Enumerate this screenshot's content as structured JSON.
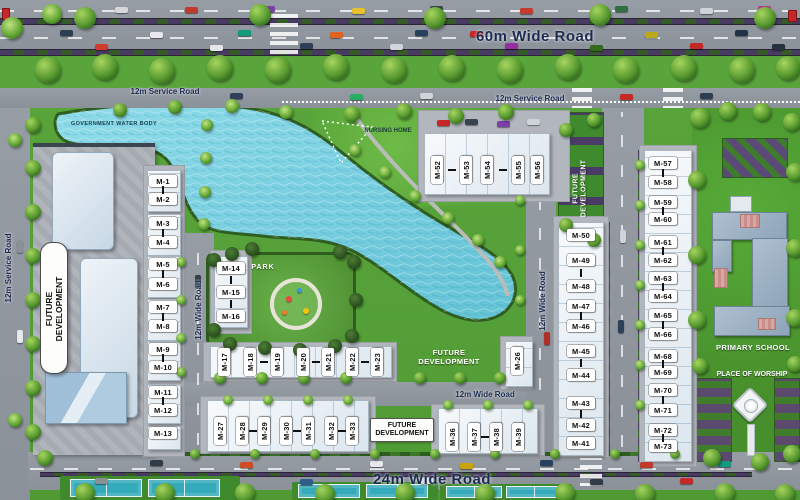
{
  "roads": {
    "highway": "60m Wide Road",
    "service_top_left": "12m Service Road",
    "service_top_right": "12m Service Road",
    "service_left": "12m Service Road",
    "wide_mid": "12m Wide Road",
    "wide_center": "12m Wide Road",
    "wide_horizontal": "12m Wide Road",
    "bottom": "24m Wide Road"
  },
  "landmarks": {
    "water_body": "GOVERNMENT WATER BODY",
    "nursing_home": "NURSING HOME",
    "park": "PARK",
    "primary_school": "PRIMARY SCHOOL",
    "place_of_worship": "PLACE OF WORSHIP"
  },
  "future_development": [
    "FUTURE DEVELOPMENT",
    "FUTURE DEVELOPMENT",
    "FUTURE DEVELOPMENT",
    "FUTURE DEVELOPMENT"
  ],
  "buildings": {
    "left_column": [
      "M-1",
      "M-2",
      "M-3",
      "M-4",
      "M-5",
      "M-6",
      "M-7",
      "M-8",
      "M-9",
      "M-10",
      "M-11",
      "M-12",
      "M-13"
    ],
    "mid_column": [
      "M-14",
      "M-15",
      "M-16"
    ],
    "row_upper": [
      "M-17",
      "M-18",
      "M-19",
      "M-20",
      "M-21",
      "M-22",
      "M-23"
    ],
    "row_lower": [
      "M-27",
      "M-28",
      "M-29",
      "M-30",
      "M-31",
      "M-32",
      "M-33"
    ],
    "row_south_center": [
      "M-36",
      "M-37",
      "M-38",
      "M-39"
    ],
    "standalone": [
      "M-26"
    ],
    "center_column": [
      "M-50",
      "M-49",
      "M-48",
      "M-47",
      "M-46",
      "M-45",
      "M-44",
      "M-43",
      "M-42",
      "M-41"
    ],
    "north_row": [
      "M-52",
      "M-53",
      "M-54",
      "M-55",
      "M-56"
    ],
    "east_column": [
      "M-57",
      "M-58",
      "M-59",
      "M-60",
      "M-61",
      "M-62",
      "M-63",
      "M-64",
      "M-65",
      "M-66",
      "M-68",
      "M-69",
      "M-70",
      "M-71",
      "M-72",
      "M-73"
    ]
  },
  "colors": {
    "water": "#7ed1e2",
    "water_deep": "#5fbcd2",
    "grass": "#55a038",
    "road": "#90969e",
    "road_label": "#1b2a50",
    "building": "#f2f6fa",
    "label_bg": "#ffffff",
    "label_text": "#0d0d0d",
    "hedge": "#4a3d5e"
  }
}
